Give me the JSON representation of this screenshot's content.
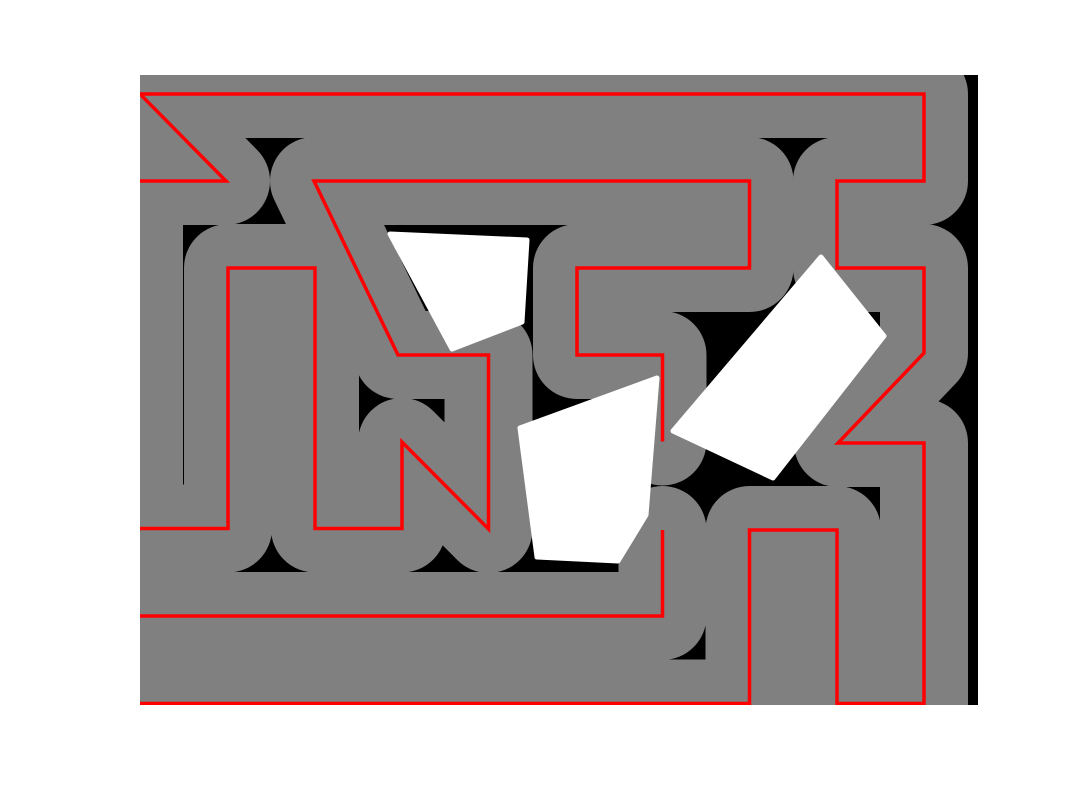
{
  "scene": {
    "canvas": {
      "width": 1080,
      "height": 810,
      "background": "#ffffff"
    },
    "workspace": {
      "x": 140,
      "y": 75,
      "width": 838,
      "height": 630,
      "fill": "#000000"
    },
    "coverage": {
      "color": "#808080",
      "swath_width": 88,
      "linecap": "round",
      "linejoin": "round"
    },
    "path_style": {
      "color": "#ff0000",
      "line_width": 3.5
    },
    "path_strands": [
      {
        "name": "path-strand-outer",
        "points": [
          [
            140,
            181
          ],
          [
            226,
            181
          ],
          [
            140,
            94
          ],
          [
            924,
            94
          ],
          [
            924,
            181
          ],
          [
            837,
            181
          ],
          [
            837,
            268
          ],
          [
            924,
            268
          ],
          [
            924,
            353
          ],
          [
            838,
            443
          ],
          [
            924,
            443
          ],
          [
            924,
            703.5
          ],
          [
            837,
            703.5
          ],
          [
            837,
            530
          ],
          [
            749.5,
            530
          ],
          [
            749.5,
            703.5
          ],
          [
            140,
            703.5
          ]
        ]
      },
      {
        "name": "path-strand-lower-middle",
        "points": [
          [
            662.5,
            530
          ],
          [
            662.5,
            616
          ],
          [
            140,
            616
          ]
        ]
      },
      {
        "name": "path-strand-inner",
        "points": [
          [
            662.5,
            441.5
          ],
          [
            662.5,
            355
          ],
          [
            577,
            355
          ],
          [
            577,
            268
          ],
          [
            749.5,
            268
          ],
          [
            749.5,
            181
          ],
          [
            314,
            181
          ],
          [
            398,
            355
          ],
          [
            488.5,
            355
          ],
          [
            488.5,
            529
          ],
          [
            402,
            442
          ],
          [
            402,
            528.5
          ],
          [
            315,
            528.5
          ],
          [
            315,
            268
          ],
          [
            228,
            268
          ],
          [
            228,
            528.5
          ],
          [
            140,
            528.5
          ]
        ]
      }
    ],
    "coverage_only_strands": [
      {
        "name": "left-boundary-transit",
        "points": [
          [
            139,
            181
          ],
          [
            139,
            529
          ]
        ]
      }
    ],
    "obstacles": [
      {
        "name": "obstacle-wedge",
        "fill": "#ffffff",
        "points": [
          [
            390,
            234
          ],
          [
            527,
            240
          ],
          [
            522,
            322
          ],
          [
            452,
            349
          ]
        ]
      },
      {
        "name": "obstacle-pentagon",
        "fill": "#ffffff",
        "points": [
          [
            520,
            428
          ],
          [
            657,
            378
          ],
          [
            646,
            515
          ],
          [
            618,
            561
          ],
          [
            537,
            557
          ]
        ]
      },
      {
        "name": "obstacle-rotated-rect",
        "fill": "#ffffff",
        "points": [
          [
            821,
            257
          ],
          [
            884,
            336
          ],
          [
            773,
            478
          ],
          [
            673,
            431
          ]
        ]
      }
    ]
  }
}
